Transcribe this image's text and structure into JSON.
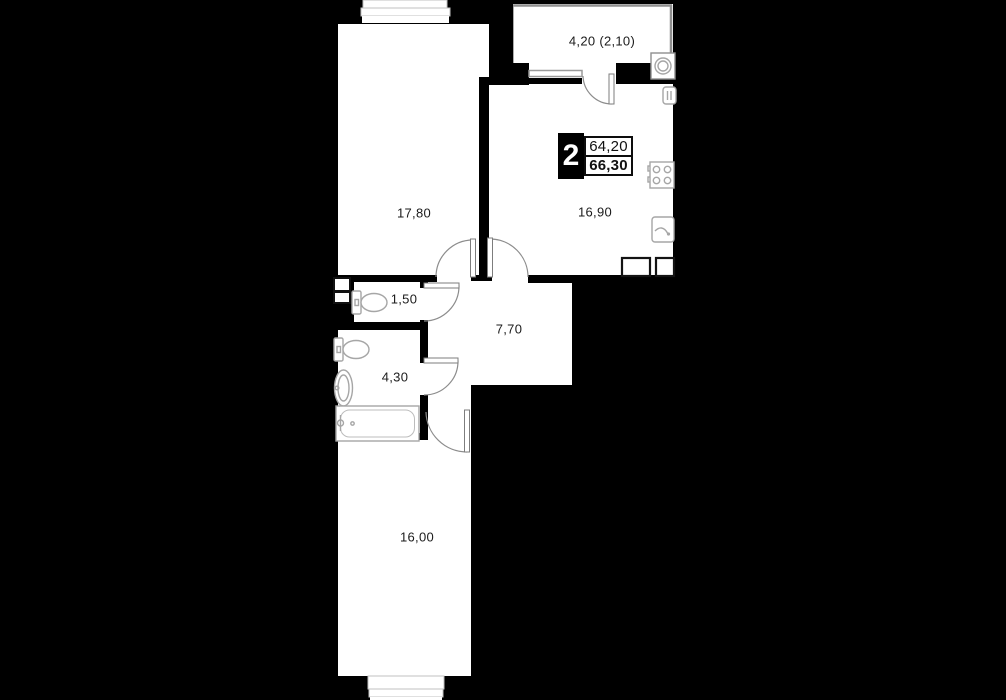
{
  "plan": {
    "type": "apartment-floor-plan",
    "unit_badge": {
      "rooms": "2",
      "area_upper": "64,20",
      "area_lower": "66,30"
    },
    "rooms": {
      "living": {
        "area": "17,80"
      },
      "kitchen": {
        "area": "16,90"
      },
      "balcony": {
        "area": "4,20 (2,10)"
      },
      "wc": {
        "area": "1,50"
      },
      "hallway": {
        "area": "7,70"
      },
      "bathroom": {
        "area": "4,30"
      },
      "bedroom": {
        "area": "16,00"
      }
    },
    "icons": [
      "washing-machine-icon",
      "boiler-icon",
      "stove-icon",
      "kitchen-sink-icon",
      "kitchen-counter-icon",
      "toilet-icon",
      "toilet-icon",
      "wash-basin-icon",
      "bathtub-icon",
      "vent-shaft-icon",
      "window-icon",
      "door-arc-icon"
    ],
    "colors": {
      "background": "#000000",
      "floor": "#ffffff",
      "wall": "#000000",
      "fixture_line": "#a6a6a6",
      "door_line": "#8c8c8c",
      "label_text": "#1b1b1b",
      "badge_bg": "#000000",
      "badge_text": "#ffffff"
    }
  }
}
